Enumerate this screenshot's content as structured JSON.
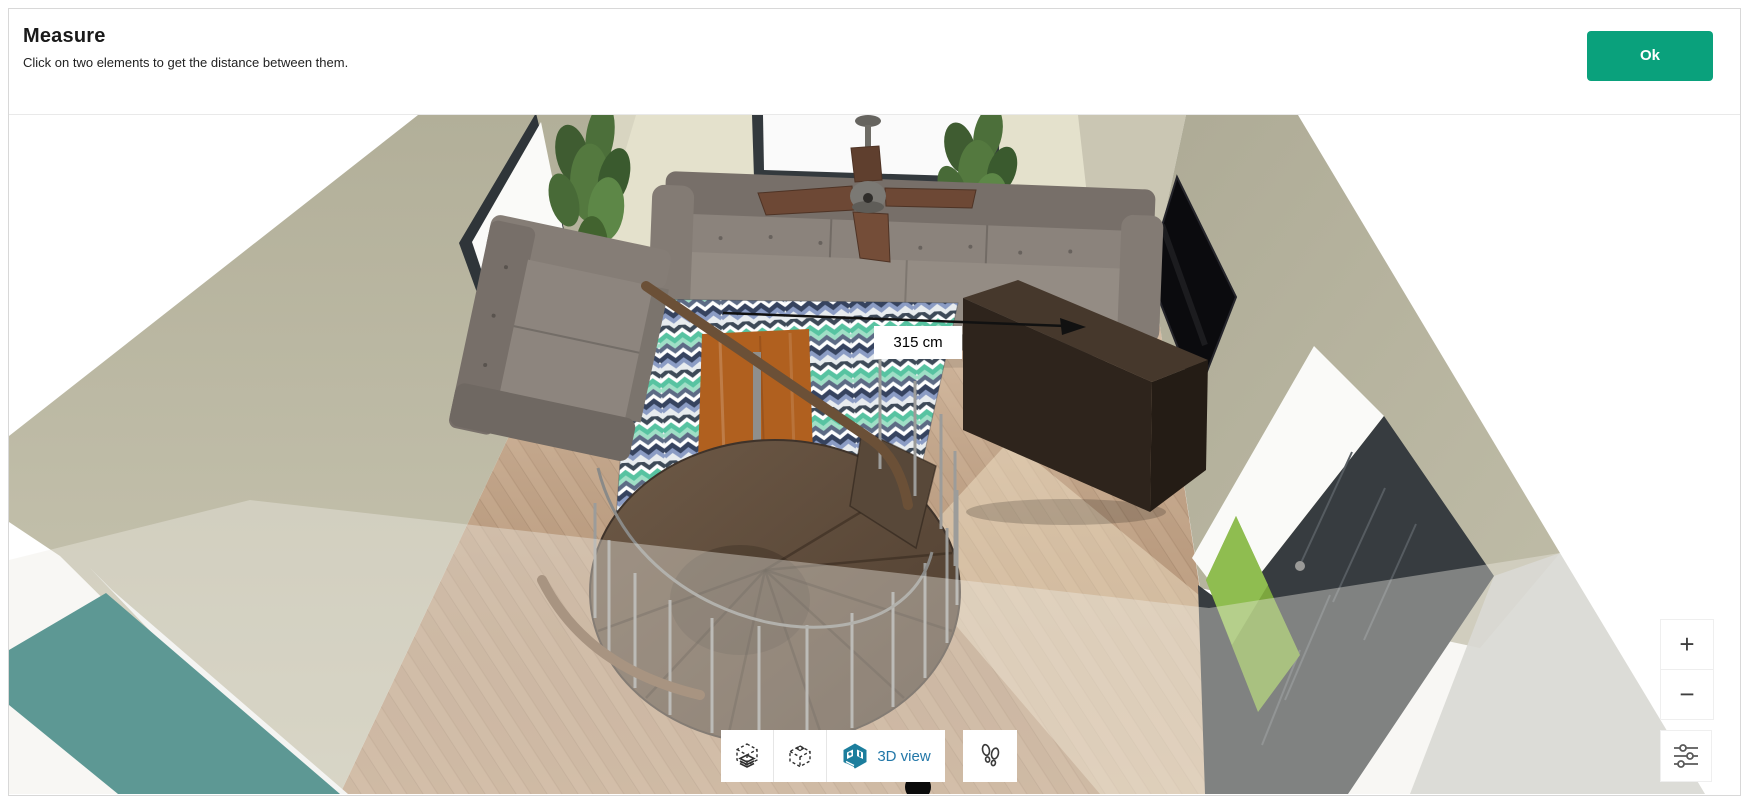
{
  "header": {
    "title": "Measure",
    "subtitle": "Click on two elements to get the distance between them.",
    "ok_label": "Ok"
  },
  "measurement": {
    "distance_label": "315 cm"
  },
  "view_toolbar": {
    "buttons": [
      {
        "name": "floor-plan-view",
        "icon": "floor-plan-icon",
        "label": ""
      },
      {
        "name": "orbit-view",
        "icon": "orbit-cube-icon",
        "label": ""
      },
      {
        "name": "3d-view",
        "icon": "3d-cube-icon",
        "label": "3D view",
        "active": true
      },
      {
        "name": "first-person-view",
        "icon": "footprints-icon",
        "label": ""
      }
    ]
  },
  "zoom_controls": {
    "zoom_in_label": "+",
    "zoom_out_label": "−"
  },
  "display_settings": {
    "icon": "sliders-icon"
  },
  "scene": {
    "objects": [
      "gray-sofa",
      "sectional-sofa",
      "coffee-table",
      "chevron-rug",
      "spiral-staircase",
      "wall-tv",
      "tv-console",
      "ceiling-fan",
      "plant-left",
      "plant-right",
      "back-window",
      "left-window",
      "entry-door",
      "teal-accent-wall",
      "wood-floor"
    ]
  },
  "colors": {
    "ok_button_green": "#0aa17c",
    "view_label_blue": "#2277a8",
    "view_icon_teal": "#1c7e9d",
    "wall_olive": "#b5b29c",
    "wall_back": "#e3e0cb",
    "teal_wall": "#5d9894",
    "floor_wood": "#c6a383",
    "rug_teal": "#57c3a1",
    "rug_navy": "#36435f",
    "sofa_gray": "#87807a",
    "table_wood": "#b0601f",
    "console_brown": "#2e241c",
    "door_gray": "#373c40",
    "grass_green": "#7da63f",
    "measure_arrow": "#111111"
  }
}
